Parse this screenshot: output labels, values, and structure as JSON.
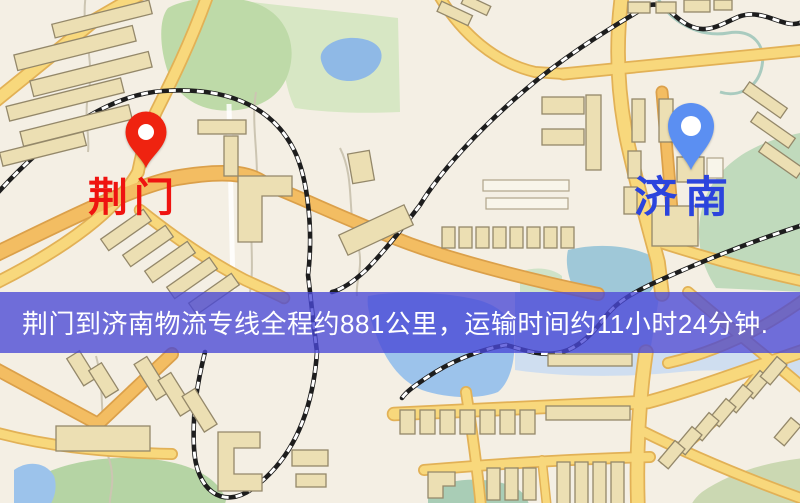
{
  "markers": {
    "origin": {
      "label": "荆门",
      "label_color": "#ef1310",
      "pin_color": "#ef2310",
      "pin_icon": "location-pin"
    },
    "destination": {
      "label": "济南",
      "label_color": "#2b44dd",
      "pin_color": "#5b8ff2",
      "pin_icon": "location-pin"
    }
  },
  "banner": {
    "text": "荆门到济南物流专线全程约881公里，运输时间约11小时24分钟.",
    "background": "rgba(73,72,214,0.78)",
    "text_color": "#ffffff"
  },
  "map": {
    "background_color": "#f4efe4",
    "road_color": "#f8d87c",
    "major_road_color": "#f3bd62",
    "park_color": "#bedaa8",
    "water_color": "#9cc3eb",
    "building_color": "#ecdfb3",
    "railway_color": "#1d1d1d"
  }
}
